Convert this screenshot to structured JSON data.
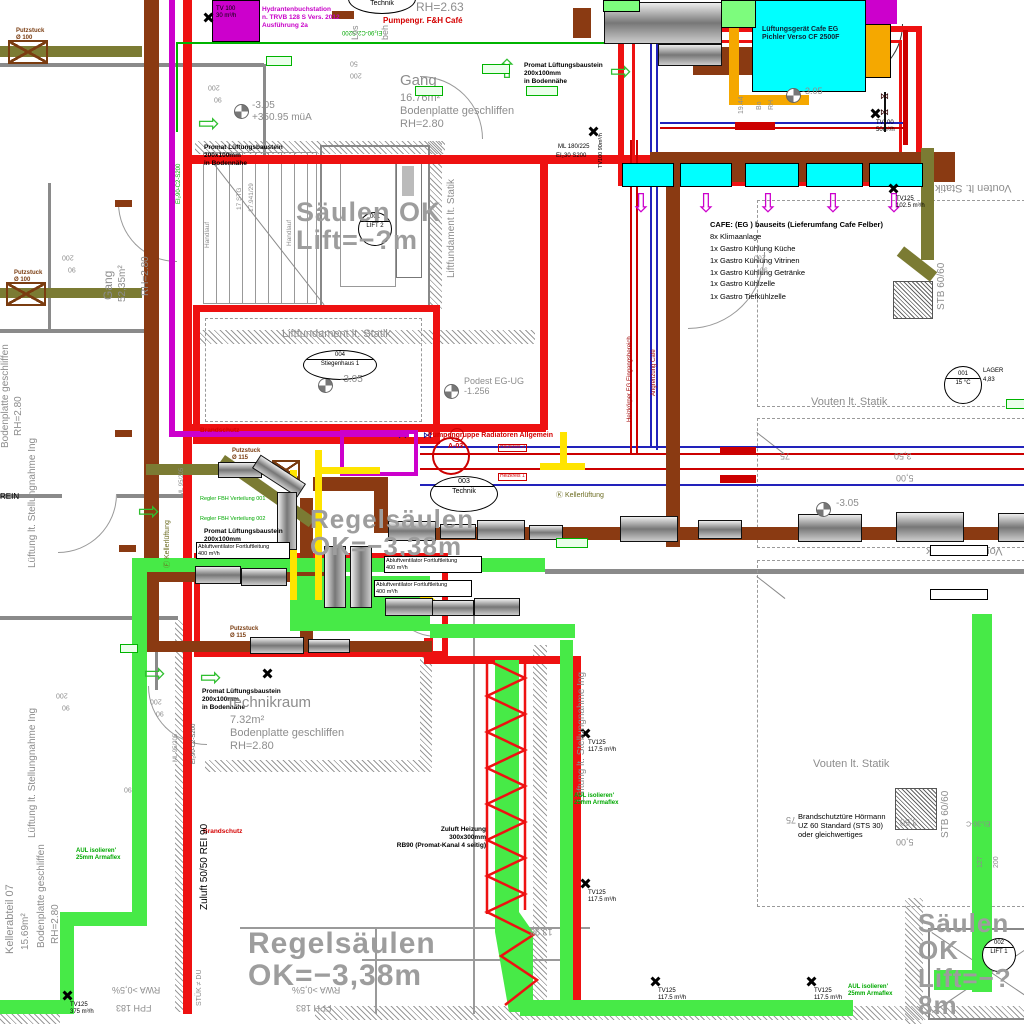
{
  "colors": {
    "fire_wall": "#ee1111",
    "supply_duct": "#47ea47",
    "exhaust_duct": "#8a3a12",
    "olive_duct": "#7b7b33",
    "hydrant": "#cc00cc",
    "ac_unit": "#00ffff",
    "heating_pipe": "#cc0000",
    "cold_pipe": "#2222bb",
    "warm_pipe": "#ffe400"
  },
  "t": {
    "hydrant": "Hydrantenbuchstation\nn. TRVB 128 S Vers. 2012\nAusführung 2a",
    "tv100_30": "TV 100\n30 m³/h",
    "rh263": "RH=2.63",
    "technik_top": "Technik",
    "pumpengr": "Pumpengr. F&H Café",
    "putz100": "Putzstuck\nØ 100",
    "putz115": "Putzstuck\nØ 115",
    "luftger": "Lüftungsgerät Cafe EG\nPichler Verso CF 2500F",
    "promat": "Promat Lüftungsbaustein\n200x100mm\nin Bodennähe",
    "gang": "Gang",
    "gang_rest": "16.76m²\nBodenplatte geschliffen\nRH=2.80",
    "gang2": "Gang",
    "gang2a": "52,35m²",
    "lvl305": "-3.05",
    "muA": "+350.95 müA",
    "lvl1256": "-1.256",
    "ml180": "ML 180/225",
    "ei30": "EI₂30 S200",
    "tv100_90": "TV100 90m³/h",
    "tv100_50": "TV100\n50m³/h",
    "tv125_1025": "TV125\n102.5 m³/h",
    "tv125_1175": "TV125\n117.5 m³/h",
    "tv125_375": "TV125\n375 m³/h",
    "saeulen1": "Säulen OK\nLift=−?m",
    "saeulen2": "Säulen OK\nLift=−?8m",
    "regels": "Regelsäulen\nOK=−3,38m",
    "vouten": "Vouten lt. Statik",
    "cafe_title": "CAFE: (EG ) bauseits (Lieferumfang Cafe Felber)",
    "cafe_l1": "8x Klimaanlage",
    "cafe_l2": "1x Gastro Kühlung Küche",
    "cafe_l3": "1x Gastro Kühlung Vitrinen",
    "cafe_l4": "1x Gastro Kühlung Getränke",
    "cafe_l5": "1x Gastro Kühlzelle",
    "cafe_l6": "1x Gastro Tiefkühlzelle",
    "stb": "STB 60/60",
    "liftfund": "Liftfundament lt. Statik",
    "stg": "17 STG",
    "stg2": "17.941/29",
    "handlauf": "Handlauf",
    "tag004": "004",
    "tag004n": "Stiegenhaus 1",
    "tag003": "003",
    "tag003n": "Technik",
    "tag001": "001",
    "tag001t": "15 °C",
    "lager": "LAGER",
    "lager_a": "4,83",
    "tagL2no": "001",
    "tagL2": "LIFT 2",
    "tagL1no": "002",
    "tagL1": "LIFT 1",
    "podest": "Podest EG-UG",
    "brandschutz": "Brandschutz",
    "pumpgr1": "Pumpengruppe Radiatoren Allgemein",
    "pumpgr2": "A-03",
    "hk1": "Heizkreis 1",
    "hk2": "Heizkreis 2",
    "kellerlK": "Ⓚ Kellerlüftung",
    "kellerlF": "Ⓕ Kellerlüftung",
    "regler1": "Regler FBH Verteilung 001",
    "regler2": "Regler FBH Verteilung 002",
    "abluft": "Abluftventilator Fortluftleitung\n400 m³/h",
    "techraum": "Technikraum",
    "techraum_rest": "7.32m²\nBodenplatte geschliffen\nRH=2.80",
    "ka07": "Kellerabteil 07",
    "ka07a": "15.69m²",
    "bodenpl": "Bodenplatte geschliffen",
    "rh280": "RH=2.80",
    "luefstell": "Lüftung lt. Stellungnahme Ing",
    "zuluft5050": "Zuluft 50/50 REI 90",
    "aul": "AUL isolieren'\n25mm Armaflex",
    "zuluft_heiz": "Zuluft Heizung\n300x300mm\nRB90 (Promat-Kanal 4 seitig)",
    "brandtuer": "Brandschutztüre Hörmann\nUZ 60 Standard (STS 30)\noder gleichwertiges",
    "rwa": "RWA >0,5%",
    "fph": "FPH 183",
    "stuek": "STÜK ≠ DU",
    "ei90": "EI₂90-C2-S200",
    "ml95": "ML 95/205",
    "ei230c": "EI₂30-C",
    "rein": "REIN",
    "d200": "200",
    "d90": "90",
    "d50": "50",
    "d75": "75",
    "d350": "3,50",
    "d500": "5,00",
    "d127": "127",
    "d1398": "13.98",
    "d1944": "19.44",
    "bo": "Bo",
    "rh_p": "RH",
    "loes": "Lös",
    "beh": "beh",
    "heizk_eg": "Heizkörper EG Eingangsbereich",
    "angr": "Angrenzung Café"
  }
}
